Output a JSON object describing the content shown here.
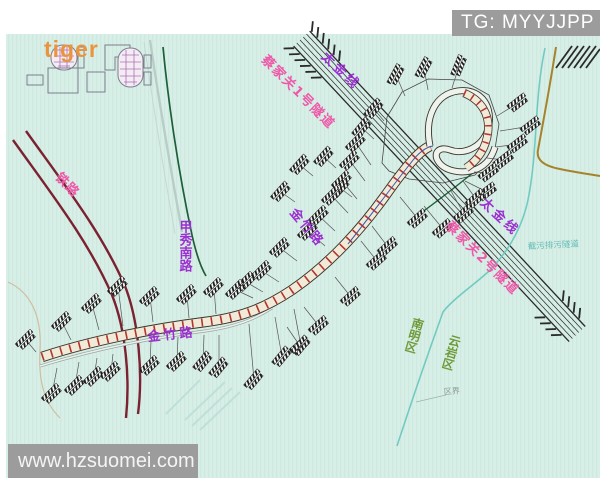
{
  "watermarks": {
    "telegram": "TG: MYYJJPP",
    "site": "www.hzsuomei.com",
    "corner": "tiger"
  },
  "map": {
    "labels": {
      "railway": "铁路",
      "jiaxiu_south_road": "甲秀南路",
      "jinzhu_road": "金竹路",
      "taijin_line": "太金线",
      "caijiaguan_tunnel_1": "蔡家关1号隧道",
      "caijiaguan_tunnel_2": "蔡家关2号隧道",
      "sewage_tunnel": "截污排污隧道",
      "nanming_district": "南明区",
      "yunyan_district": "云岩区",
      "district_boundary": "区界"
    },
    "colors": {
      "background": "#d7eee6",
      "railway": "#7a2231",
      "road_label_purple": "#9b30d0",
      "tunnel_label_pink": "#ee58a8",
      "district_label_green": "#6f9a3a",
      "boundary_teal": "#66c6be",
      "green_road": "#1d5f38",
      "bridge_tie_red": "#b5352c",
      "utility_line_brown": "#a5832b",
      "watermark_gray": "#9c9c9c"
    },
    "buildings": [
      [
        396,
        75,
        -62,
        405,
        96
      ],
      [
        424,
        68,
        -62,
        428,
        90
      ],
      [
        459,
        66,
        -68,
        452,
        88
      ],
      [
        518,
        103,
        -38,
        497,
        116
      ],
      [
        531,
        126,
        -38,
        500,
        131
      ],
      [
        518,
        144,
        -38,
        496,
        147
      ],
      [
        504,
        160,
        -38,
        487,
        158
      ],
      [
        489,
        173,
        -38,
        474,
        172
      ],
      [
        487,
        192,
        -38,
        465,
        181
      ],
      [
        374,
        109,
        -50,
        384,
        121
      ],
      [
        362,
        128,
        -50,
        374,
        139
      ],
      [
        324,
        157,
        -48,
        336,
        168
      ],
      [
        300,
        165,
        -48,
        313,
        176
      ],
      [
        340,
        188,
        -48,
        352,
        197
      ],
      [
        281,
        192,
        -48,
        295,
        202
      ],
      [
        356,
        143,
        -45,
        371,
        165
      ],
      [
        350,
        161,
        -45,
        365,
        181
      ],
      [
        342,
        181,
        -45,
        357,
        199
      ],
      [
        332,
        196,
        -45,
        348,
        213
      ],
      [
        319,
        216,
        -45,
        335,
        231
      ],
      [
        308,
        231,
        -45,
        325,
        246
      ],
      [
        280,
        248,
        -45,
        297,
        261
      ],
      [
        262,
        271,
        -45,
        279,
        282
      ],
      [
        246,
        282,
        -45,
        263,
        292
      ],
      [
        236,
        290,
        -45,
        253,
        298
      ],
      [
        418,
        219,
        -42,
        400,
        197
      ],
      [
        443,
        229,
        -42,
        424,
        206
      ],
      [
        464,
        214,
        -42,
        451,
        191
      ],
      [
        476,
        199,
        -42,
        463,
        181
      ],
      [
        388,
        247,
        -42,
        372,
        226
      ],
      [
        377,
        261,
        -42,
        361,
        241
      ],
      [
        351,
        297,
        -42,
        335,
        277
      ],
      [
        319,
        326,
        -42,
        304,
        307
      ],
      [
        300,
        346,
        -42,
        287,
        327
      ],
      [
        26,
        340,
        -45,
        36,
        352
      ],
      [
        62,
        322,
        -45,
        71,
        340
      ],
      [
        92,
        304,
        -45,
        99,
        330
      ],
      [
        118,
        287,
        -45,
        123,
        326
      ],
      [
        150,
        297,
        -45,
        153,
        322
      ],
      [
        187,
        295,
        -45,
        189,
        318
      ],
      [
        214,
        288,
        -45,
        216,
        314
      ],
      [
        52,
        394,
        -45,
        57,
        368
      ],
      [
        75,
        386,
        -45,
        79,
        362
      ],
      [
        94,
        377,
        -45,
        97,
        358
      ],
      [
        111,
        372,
        -45,
        113,
        354
      ],
      [
        150,
        366,
        -45,
        151,
        341
      ],
      [
        177,
        362,
        -45,
        178,
        337
      ],
      [
        203,
        362,
        -50,
        204,
        335
      ],
      [
        219,
        368,
        -50,
        219,
        335
      ],
      [
        254,
        380,
        -50,
        249,
        324
      ],
      [
        282,
        357,
        -50,
        275,
        317
      ],
      [
        301,
        346,
        -50,
        294,
        309
      ]
    ]
  }
}
